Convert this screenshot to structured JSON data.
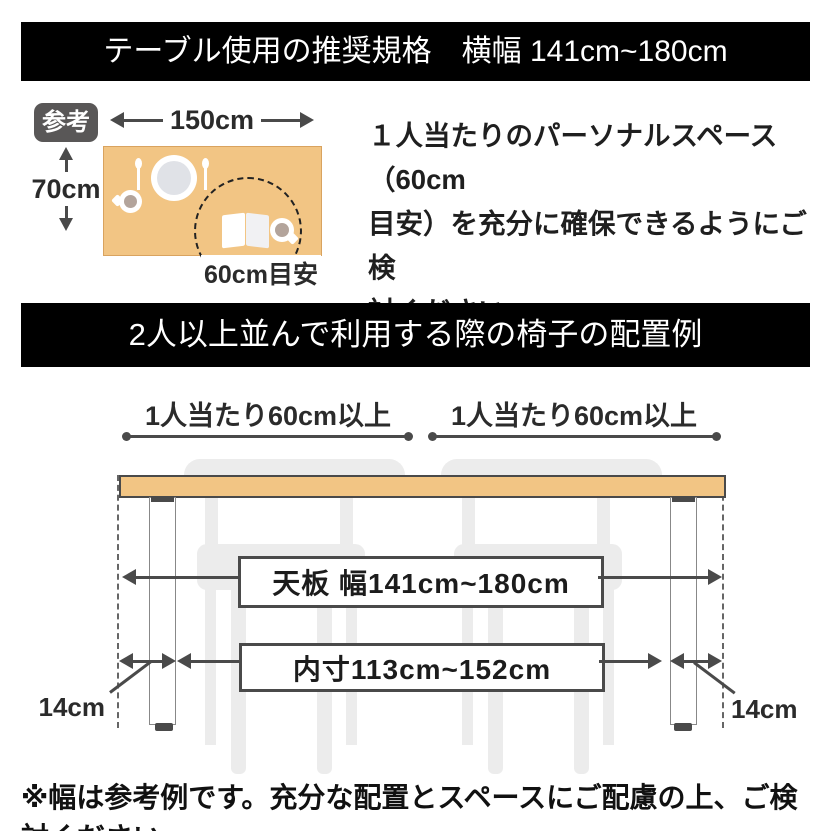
{
  "colors": {
    "banner_bg": "#000000",
    "banner_text": "#ffffff",
    "table_top": "#f2c584",
    "table_border_soft": "#d9a35f",
    "outline_dark": "#4a4a4a",
    "chair_gray": "#ececec",
    "badge_bg": "#595757",
    "cup_fill": "#b3a49b"
  },
  "banner_top": {
    "title": "テーブル使用の推奨規格　横幅 141cm~180cm"
  },
  "reference": {
    "badge_label": "参考",
    "table_width_label": "150cm",
    "table_depth_label": "70cm",
    "personal_space_label": "60cm目安",
    "description_lines": [
      "１人当たりのパーソナルスペース（60cm",
      "目安）を充分に確保できるようにご検",
      "討ください。"
    ]
  },
  "banner_arrangement": {
    "title": "2人以上並んで利用する際の椅子の配置例"
  },
  "arrangement": {
    "per_person_label_left": "1人当たり60cm以上",
    "per_person_label_right": "1人当たり60cm以上",
    "tabletop_width_label": "天板 幅141cm~180cm",
    "inner_width_label": "内寸113cm~152cm",
    "leg_inset_label_left": "14cm",
    "leg_inset_label_right": "14cm"
  },
  "footer": {
    "note": "※幅は参考例です。充分な配置とスペースにご配慮の上、ご検討ください。"
  }
}
